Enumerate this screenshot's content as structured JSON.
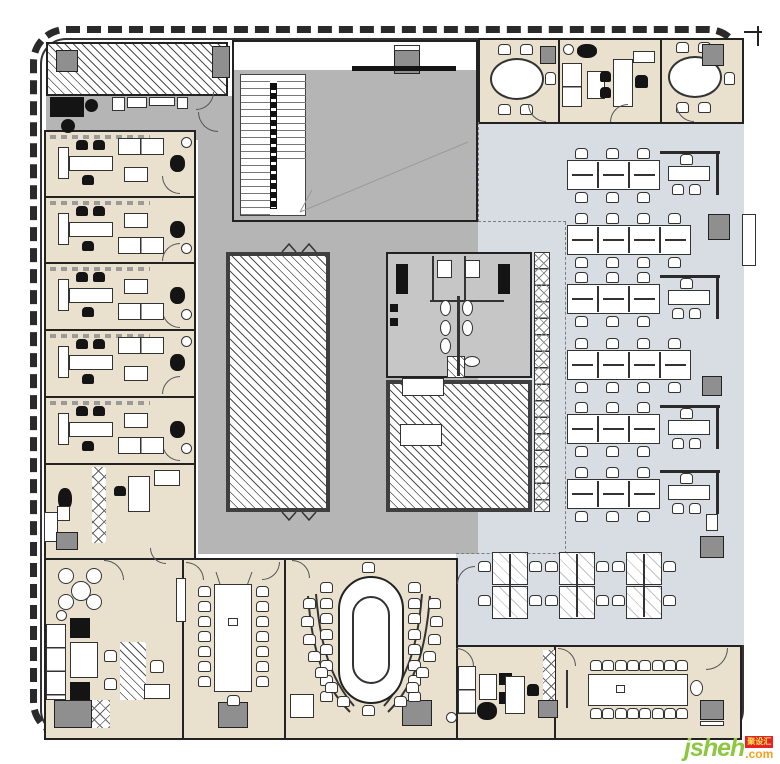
{
  "page": {
    "background": "#ffffff",
    "kind": "office floor plan drawing"
  },
  "watermark": {
    "brand": "jsheh",
    "suffix": ".com",
    "badge": "聚设汇",
    "brand_color": "#8dc63f",
    "suffix_color": "#f6a01d",
    "badge_bg": "#e62129",
    "badge_fg": "#ffe94e"
  },
  "palette": {
    "floor_office": "#e9e1cd",
    "floor_open": "#d8dce3",
    "floor_core": "#b5b5b5",
    "floor_restroom": "#c6c6c6",
    "wall": "#2a2a2a",
    "cabinet_gray": "#8f8f8f",
    "furniture_black": "#141414",
    "hatch_line": "#4f4f4f"
  },
  "open_office": {
    "row_x": 567,
    "row_y": [
      160,
      225,
      284,
      350,
      414,
      479
    ],
    "rows": [
      "A",
      "B",
      "A",
      "B",
      "A",
      "A"
    ],
    "module_width": 31,
    "bench_height": 30,
    "pods": {
      "y": 552,
      "xs": [
        492,
        559,
        626
      ]
    }
  },
  "left_offices": {
    "x": 44,
    "ys": [
      131,
      197,
      263,
      330,
      397
    ],
    "sofa_side": [
      "top",
      "bottom",
      "bottom",
      "top",
      "bottom"
    ]
  },
  "oval_conference": {
    "side_chairs": 8,
    "curve_chairs": 7
  },
  "vertical_conference": {
    "side_chairs": 7
  },
  "bottom_right_conference": {
    "top_chairs": 8,
    "bottom_chairs": 8
  }
}
